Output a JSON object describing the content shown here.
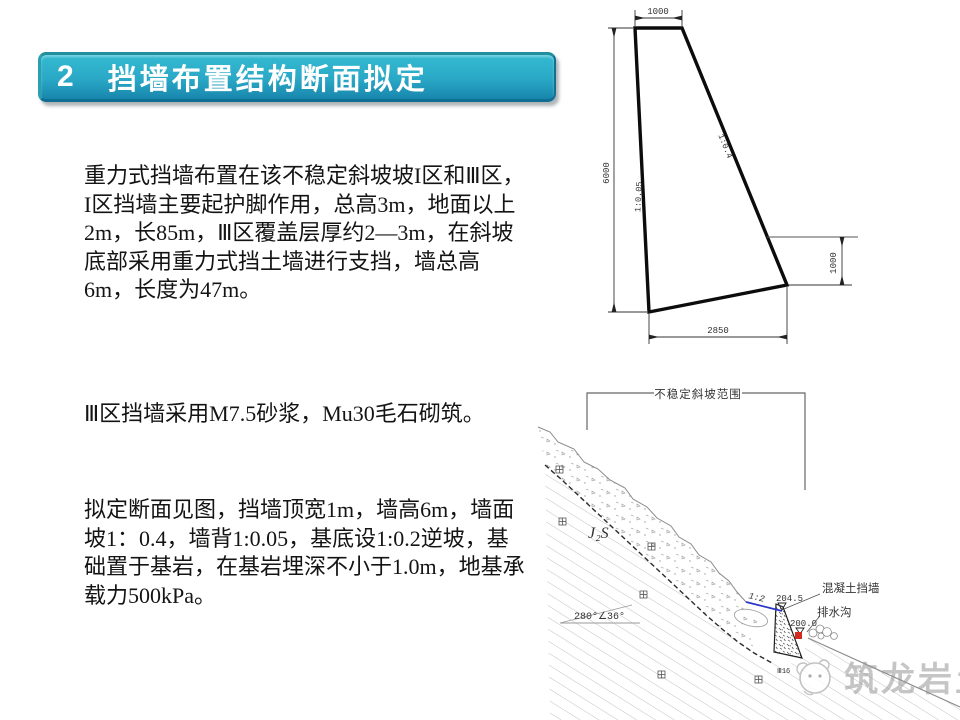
{
  "header": {
    "number": "2",
    "title": "挡墙布置结构断面拟定"
  },
  "paragraphs": [
    "重力式挡墙布置在该不稳定斜坡坡I区和Ⅲ区，I区挡墙主要起护脚作用，总高3m，地面以上2m，长85m，Ⅲ区覆盖层厚约2—3m，在斜坡底部采用重力式挡土墙进行支挡，墙总高6m，长度为47m。",
    "Ⅲ区挡墙采用M7.5砂浆，Mu30毛石砌筑。",
    "拟定断面见图，挡墙顶宽1m，墙高6m，墙面坡1：0.4，墙背1:0.05，基底设1:0.2逆坡，基础置于基岩，在基岩埋深不小于1.0m，地基承载力500kPa。"
  ],
  "section_drawing": {
    "top_width": "1000",
    "wall_height": "6000",
    "base_width": "2850",
    "embed_depth": "1000",
    "back_slope": "1:0.05",
    "face_slope": "1:0.4"
  },
  "slope_drawing": {
    "range_label": "不稳定斜坡范围",
    "strata_label": "J₂S",
    "attitude": "280°∠36°",
    "backfill_slope": "1:2",
    "wall_label": "混凝土挡墙",
    "ditch_label": "排水沟",
    "crest_elevation": "204.5",
    "toe_elevation": "200.0",
    "base_note": "Ⅲ16"
  },
  "watermark": {
    "text": "筑龙岩土"
  },
  "colors": {
    "banner_top": "#34bad1",
    "banner_bottom": "#1886ad",
    "accent_blue": "#2a35c8",
    "marker_red": "#d42a1e",
    "line_dark": "#1a1a1a",
    "line_gray": "#8a8a8a"
  }
}
